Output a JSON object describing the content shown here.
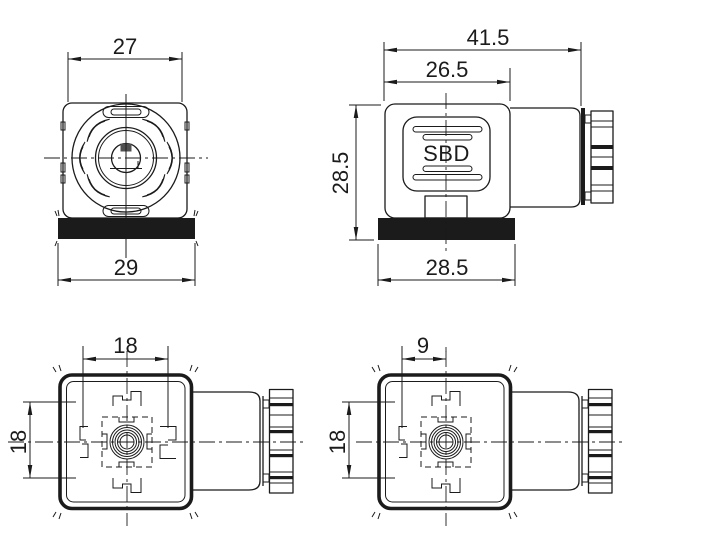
{
  "drawing": {
    "kind": "technical-drawing",
    "colors": {
      "line": "#1b1b1b",
      "background": "#ffffff",
      "gasket_fill": "#1b1b1b"
    },
    "views": {
      "front": {
        "dim_top": "27",
        "dim_bottom": "29"
      },
      "side": {
        "dim_overall": "41.5",
        "dim_body_width": "26.5",
        "dim_height": "28.5",
        "dim_base_width": "28.5",
        "brand_label": "SBD"
      },
      "bottom_form_a": {
        "dim_pin_span": "18",
        "dim_pin_span_vertical": "18"
      },
      "bottom_form_b": {
        "dim_pin_offset": "9",
        "dim_pin_span_vertical": "18"
      }
    }
  }
}
